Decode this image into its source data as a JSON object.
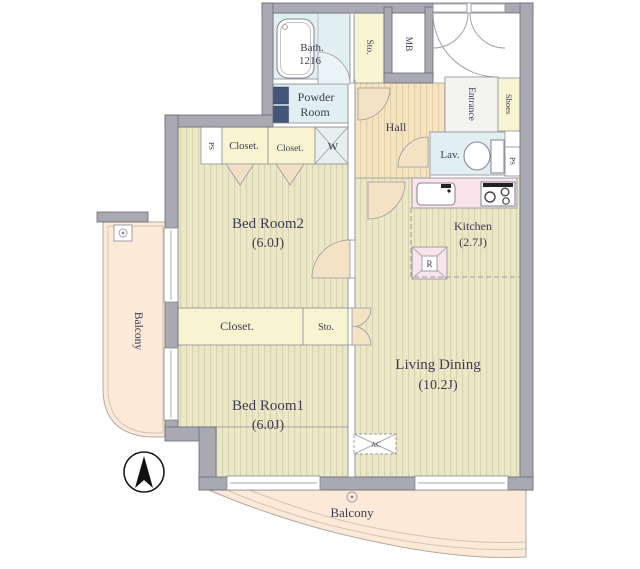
{
  "plan": {
    "type": "apartment-floor-plan",
    "labels": {
      "bath": "Bath.",
      "bath_size": "1216",
      "sto_top": "Sto.",
      "mb": "MB",
      "entrance": "Entrance",
      "shoes": "Shoes",
      "powder_line1": "Powder",
      "powder_line2": "Room",
      "hall": "Hall",
      "lav": "Lav.",
      "ps_left": "PS",
      "ps_right": "PS",
      "closet_top_left": "Closet.",
      "closet_top_right": "Closet.",
      "washer": "W",
      "bedroom2": "Bed Room2",
      "bedroom2_size": "(6.0J)",
      "kitchen": "Kitchen",
      "kitchen_size": "(2.7J)",
      "fridge": "R",
      "closet_mid": "Closet.",
      "sto_mid": "Sto.",
      "bedroom1": "Bed Room1",
      "bedroom1_size": "(6.0J)",
      "living": "Living Dining",
      "living_size": "(10.2J)",
      "ac": "AC",
      "balcony_left": "Balcony",
      "balcony_bottom": "Balcony"
    },
    "icons": [
      "compass-north-arrow",
      "bathtub",
      "toilet",
      "vanity-basin",
      "kitchen-sink",
      "stove-burners",
      "washer-cross",
      "fridge-cross",
      "ac-unit",
      "balcony-drain"
    ],
    "colors": {
      "wall": "#a9a9b3",
      "floor": "#ebe8c7",
      "floor_stripe": "#d8d2ae",
      "hall_floor": "#f5e4c2",
      "hall_stripe": "#e4cfa4",
      "closet": "#f8f3d0",
      "wet_room": "#e1eff2",
      "kitchen": "#f9e4ec",
      "balcony": "#fce9d8",
      "text": "#3c3c55"
    }
  }
}
